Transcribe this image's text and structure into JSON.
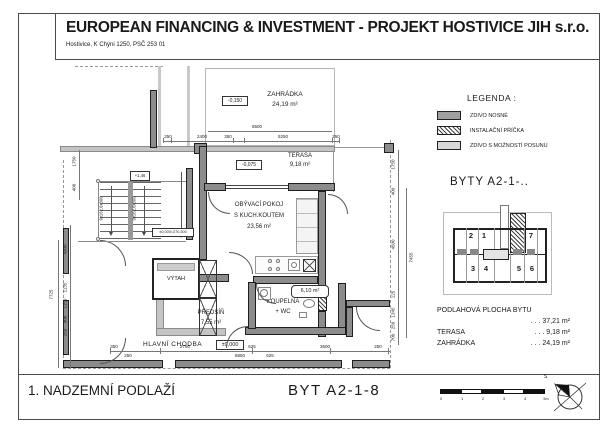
{
  "header": {
    "title": "EUROPEAN FINANCING & INVESTMENT - PROJEKT HOSTIVICE JIH s.r.o.",
    "subtitle": "Hostivice, K Chýni 1250, PSČ 253 01"
  },
  "plan": {
    "rooms": {
      "zahradka": {
        "name": "ZAHRÁDKA",
        "area": "24,19 m²",
        "level": "-0,150"
      },
      "terasa": {
        "name": "TERASA",
        "area": "9,18 m²",
        "level": "-0,075"
      },
      "obyvaci": {
        "name_line1": "OBÝVACÍ POKOJ",
        "name_line2": "S KUCH.KOUTEM",
        "area": "23,56 m²"
      },
      "predsin": {
        "name": "PŘEDSÍŇ",
        "area": "7,55 m²"
      },
      "koupelna": {
        "name_line1": "KOUPELNA",
        "name_line2": "+ WC",
        "area": "6,10 m²"
      },
      "vytah": {
        "name": "VÝTAH"
      },
      "chodba": {
        "name": "HLAVNÍ CHODBA",
        "level": "±0,000"
      }
    },
    "stairs": {
      "flight_label": "9x162,6x300",
      "level_top": "+1,46",
      "level_note": "±0,000=270,300"
    },
    "dims": {
      "top_total": "8500",
      "top": [
        "250",
        "2400",
        "350",
        "5250",
        "250"
      ],
      "bottom_row1": [
        "350",
        "2750",
        "625",
        "3500",
        "250"
      ],
      "bottom_row2": [
        "250",
        "8850",
        "625"
      ],
      "left_upper": [
        "1750",
        "400"
      ],
      "left": [
        "4300",
        "1135",
        "1150",
        "900",
        "250"
      ],
      "left_total": "7725",
      "right": [
        "1750",
        "400",
        "4500",
        "125",
        "1345",
        "250",
        "700"
      ],
      "right_total": "7455"
    }
  },
  "legend": {
    "title": "LEGENDA :",
    "items": [
      {
        "label": "ZDIVO NOSNÉ"
      },
      {
        "label": "INSTALAČNÍ PŘÍČKA"
      },
      {
        "label": "ZDIVO S MOŽNOSTÍ POSUNU"
      }
    ]
  },
  "key_plan": {
    "title": "BYTY  A2-1-..",
    "units": [
      "2",
      "1",
      "7",
      "3",
      "4",
      "5",
      "6"
    ]
  },
  "areas": {
    "rows": [
      {
        "label": "PODLAHOVÁ PLOCHA BYTU",
        "value": ". . .  37,21 m²"
      },
      {
        "label": "TERASA",
        "value": ". . .    9,18 m²"
      },
      {
        "label": "ZAHRÁDKA",
        "value": ". . .  24,19 m²"
      }
    ]
  },
  "footer": {
    "floor": "1. NADZEMNÍ PODLAŽÍ",
    "unit": "BYT  A2-1-8",
    "scale_ticks": [
      "0",
      "1",
      "2",
      "3",
      "4",
      "5m"
    ],
    "north_label": "S"
  },
  "colors": {
    "wall_bearing": "#8c8c8c",
    "wall_movable": "#c4c4c4",
    "hatch_line": "#444444",
    "line": "#777777"
  }
}
